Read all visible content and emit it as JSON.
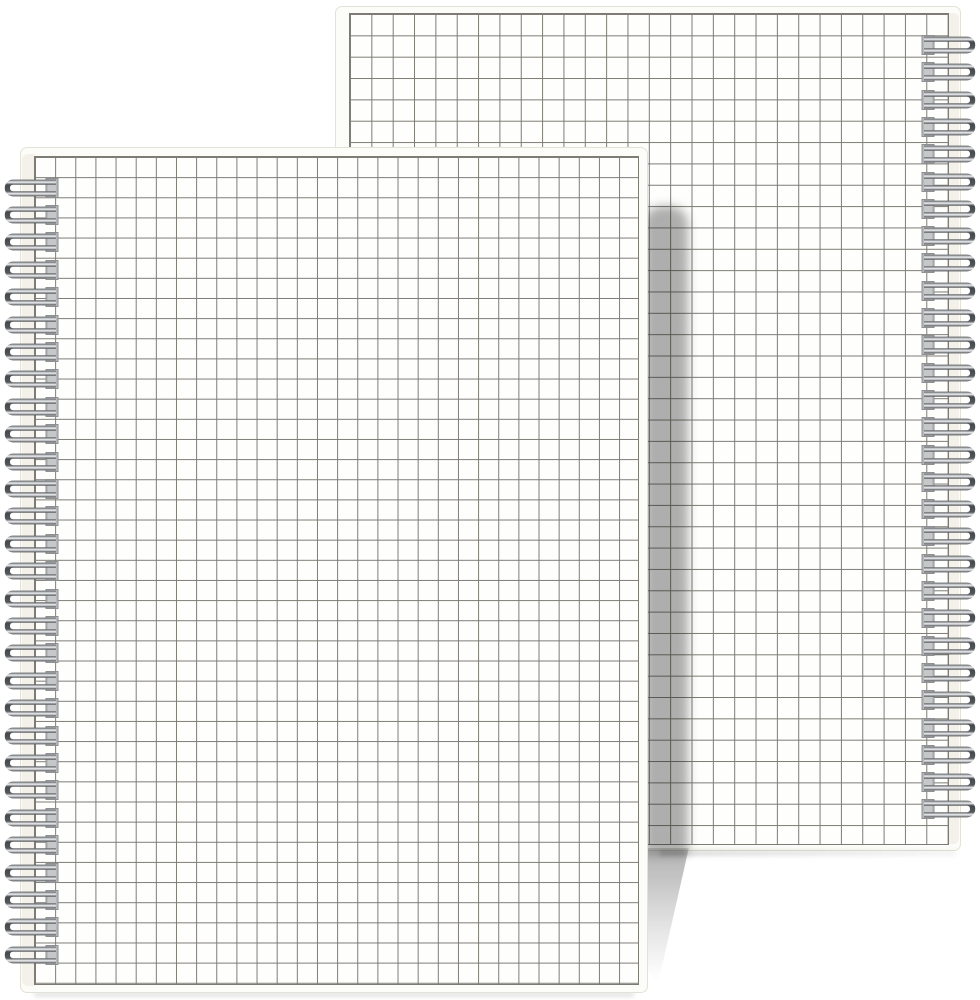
{
  "page": {
    "title": "Two spiral-bound square-grid notebooks (product photo)",
    "background_color": "#ffffff"
  },
  "notebooks": [
    {
      "id": "back",
      "position": "back, upper right, partly hidden behind front notebook",
      "binding_side": "right",
      "binding_type": "twin-loop silver wire",
      "ring_count": 29,
      "cover_style": "transparent cover over square grid paper",
      "grid_cell_px": 21.35
    },
    {
      "id": "front",
      "position": "front, lower left, overlapping back notebook",
      "binding_side": "left",
      "binding_type": "twin-loop silver wire",
      "ring_count": 29,
      "cover_style": "transparent cover over square grid paper",
      "grid_cell_px": 20.15
    }
  ],
  "colors": {
    "background": "#ffffff",
    "cover": "#fcfcf9",
    "cover_border": "#e4e2d6",
    "binding_margin": "#f3f1e9",
    "grid_line": "#7d7b74",
    "punch_hole_fill": "#b7b8ba",
    "punch_hole_border": "#8f9093",
    "wire_dark": "#4b4e51",
    "wire_light": "#eff1f3",
    "cast_shadow": "rgba(20,20,20,0.34)"
  }
}
